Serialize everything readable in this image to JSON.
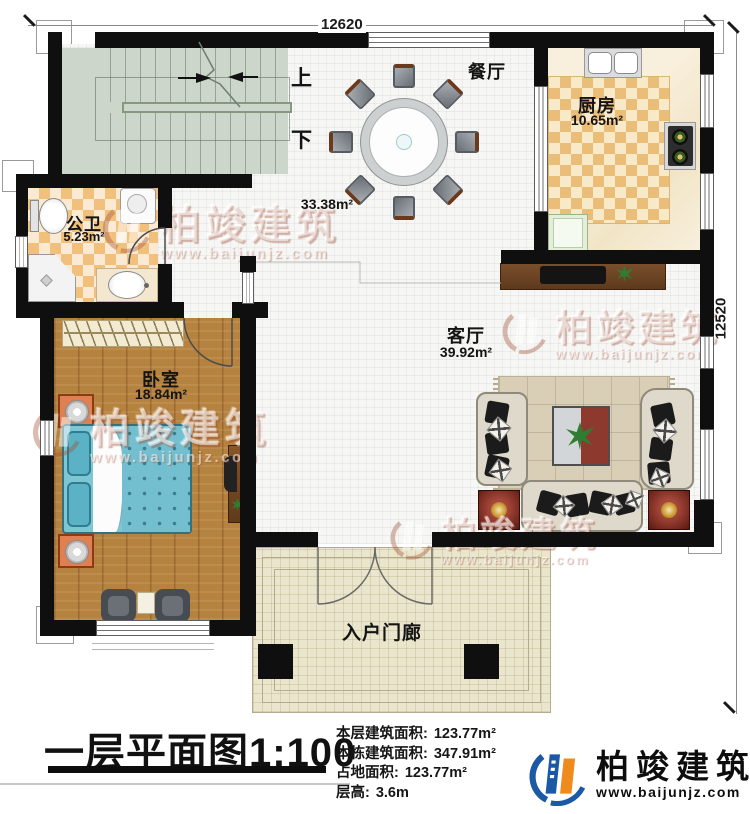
{
  "plan": {
    "dimensions": {
      "top": "12620",
      "right": "12520"
    },
    "stair": {
      "up": "上",
      "down": "下"
    },
    "rooms": {
      "dining": {
        "name": "餐厅",
        "area": "33.38m²"
      },
      "kitchen": {
        "name": "厨房",
        "area": "10.65m²"
      },
      "bathroom": {
        "name": "公卫",
        "area": "5.23m²"
      },
      "bedroom": {
        "name": "卧室",
        "area": "18.84m²"
      },
      "living": {
        "name": "客厅",
        "area": "39.92m²"
      },
      "porch": {
        "name": "入户门廊"
      }
    }
  },
  "titleblock": {
    "title": "一层平面图1:100",
    "stats": [
      {
        "label": "本层建筑面积:",
        "value": "123.77m²"
      },
      {
        "label": "本栋建筑面积:",
        "value": "347.91m²"
      },
      {
        "label": "占地面积:",
        "value": "123.77m²"
      },
      {
        "label": "层高:",
        "value": "3.6m"
      }
    ]
  },
  "brand": {
    "name": "柏竣建筑",
    "url": "www.baijunjz.com"
  },
  "watermark": {
    "name": "柏竣建筑",
    "url": "www.baijunjz.com"
  },
  "colors": {
    "wall": "#0f0f0f",
    "brand_blue": "#1b59a6",
    "brand_orange": "#ef8b1c"
  }
}
